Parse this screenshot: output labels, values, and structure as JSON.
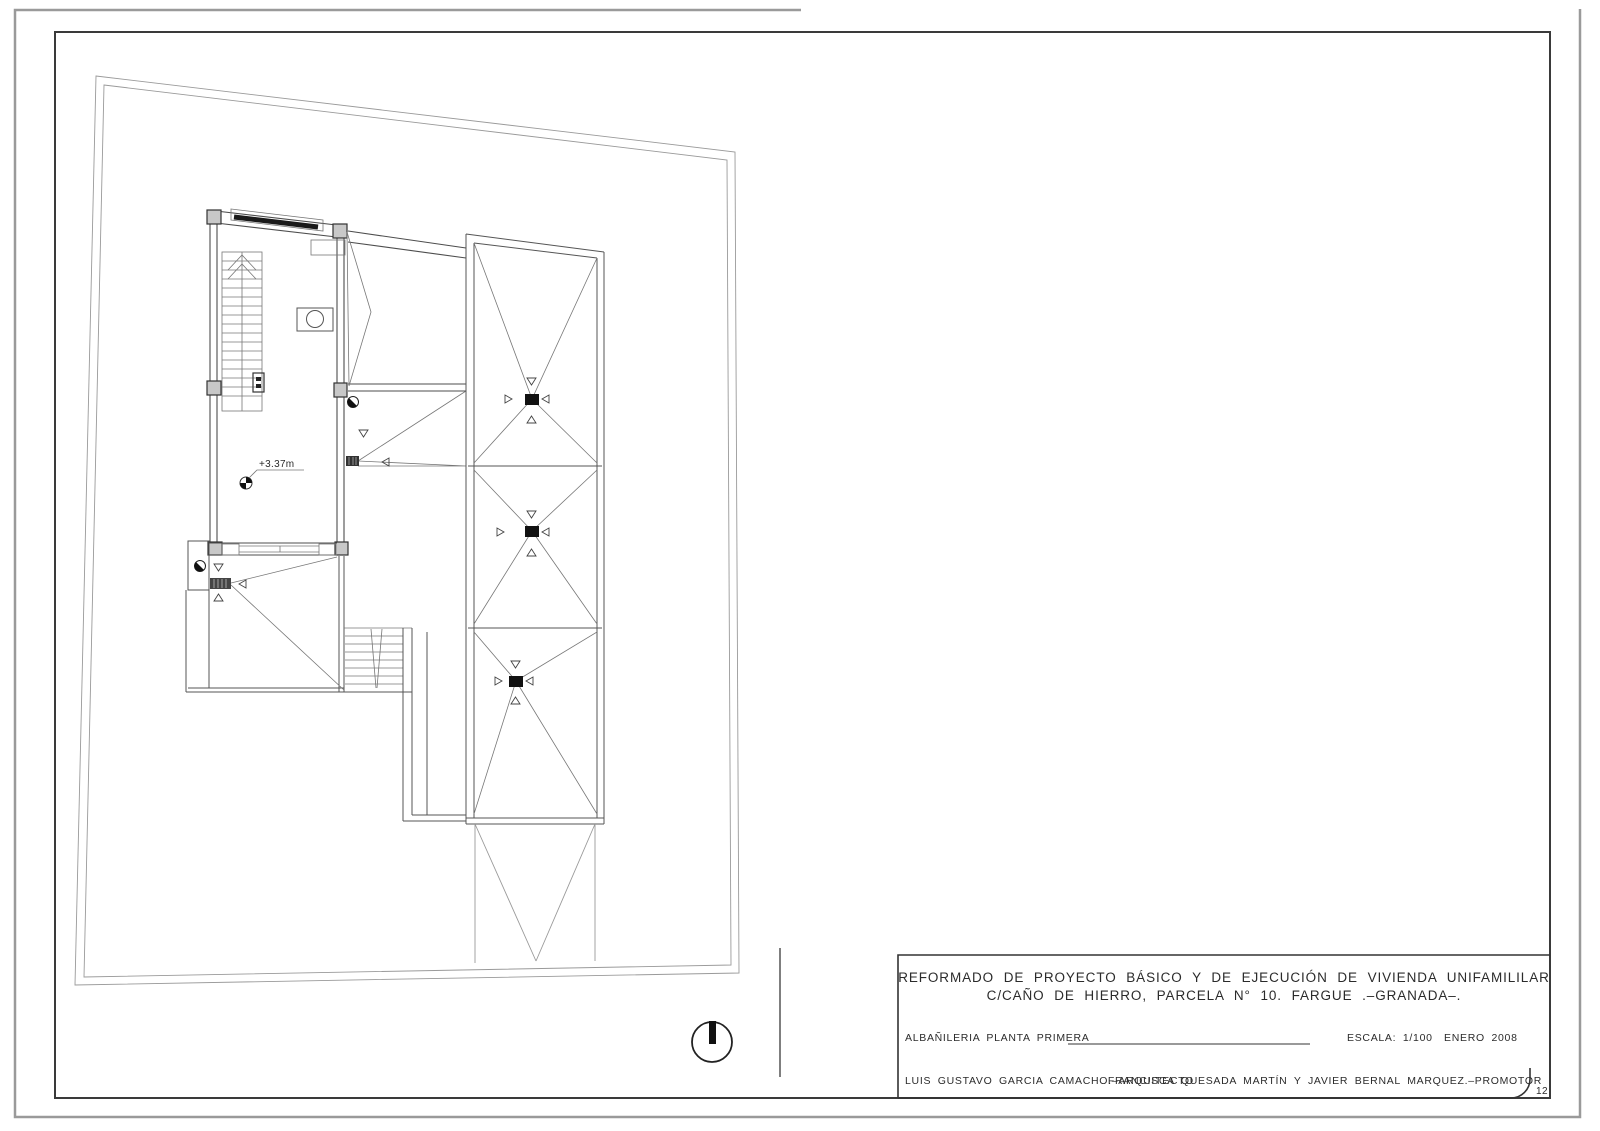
{
  "page": {
    "background": "#ffffff",
    "kind": "architectural plan sheet (scanned CAD drawing)"
  },
  "plan": {
    "level_marker_label": "+3.37m",
    "symbols": {
      "north_indicator": "north-arrow-icon",
      "roof_drain": "drain-square-icon",
      "slope_arrows": "slope-triangle-icon",
      "scupper": "half-filled-circle-icon",
      "level_point": "quadrant-circle-icon"
    }
  },
  "title_block": {
    "project_title_line1": "REFORMADO DE PROYECTO BÁSICO Y DE EJECUCIÓN DE VIVIENDA UNIFAMILILAR",
    "project_title_line2": "C/CAÑO DE HIERRO, PARCELA N° 10. FARGUE .–GRANADA–.",
    "drawing_name": "ALBAÑILERIA PLANTA PRIMERA",
    "scale": "ESCALA: 1/100",
    "date": "ENERO 2008",
    "architect": "LUIS GUSTAVO GARCIA CAMACHO.–ARQUITECTO",
    "promoter": "FRANCISCA QUESADA MARTÍN Y JAVIER BERNAL MARQUEZ.–PROMOTOR",
    "sheet_number": "12"
  },
  "colors": {
    "paper": "#ffffff",
    "outer_border": "#9a9a9a",
    "inner_border": "#3a3a3a",
    "site_boundary": "#8a8a8a",
    "plan_line": "#555555",
    "column_fill": "#c8c8c8",
    "drain_fill": "#111111"
  }
}
